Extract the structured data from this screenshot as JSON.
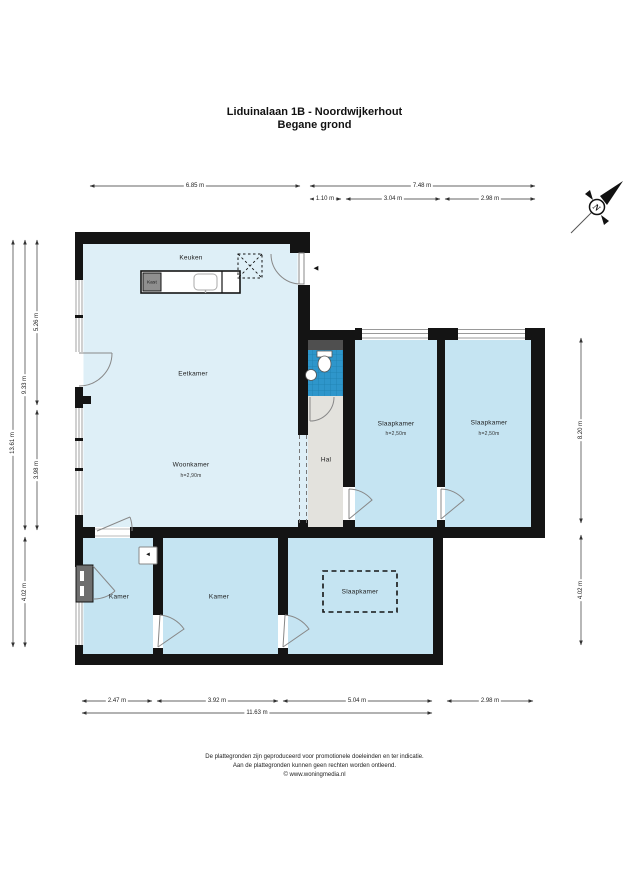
{
  "title": {
    "address": "Liduinalaan 1B - Noordwijkerhout",
    "floor": "Begane grond"
  },
  "compass": {
    "north_label": "N"
  },
  "rooms": {
    "keuken": {
      "name": "Keuken"
    },
    "kast": {
      "name": "Kast"
    },
    "eetkamer": {
      "name": "Eetkamer"
    },
    "woonkamer": {
      "name": "Woonkamer",
      "ceiling_height": "h=2,90m"
    },
    "hal": {
      "name": "Hal"
    },
    "slaapkamer_1": {
      "name": "Slaapkamer",
      "ceiling_height": "h=2,50m"
    },
    "slaapkamer_2": {
      "name": "Slaapkamer",
      "ceiling_height": "h=2,50m"
    },
    "kamer_1": {
      "name": "Kamer"
    },
    "kamer_2": {
      "name": "Kamer"
    },
    "slaapkamer_3": {
      "name": "Slaapkamer"
    }
  },
  "dimensions": {
    "top": [
      "6.85 m",
      "7.48 m",
      "1.10 m",
      "3.04 m",
      "2.98 m"
    ],
    "left": [
      "13.61 m",
      "9.33 m",
      "4.02 m",
      "5.26 m",
      "3.98 m"
    ],
    "right": [
      "8.20 m",
      "4.02 m"
    ],
    "bottom": [
      "2.47 m",
      "3.92 m",
      "5.04 m",
      "2.98 m",
      "11.63 m"
    ]
  },
  "footer": {
    "line1": "De plattegronden zijn geproduceerd voor promotionele doeleinden en ter indicatie.",
    "line2": "Aan de plattegronden kunnen geen rechten worden ontleend.",
    "line3": "© www.woningmedia.nl"
  },
  "icons": {
    "entrance_arrow": "◄",
    "wall_unit": "◄"
  },
  "colors": {
    "living_room_fill": "#DEEFF7",
    "bedroom_fill": "#C5E4F2",
    "hall_fill": "#E3E2DD",
    "toilet_tile": "#2E96CB",
    "wall": "#141414"
  }
}
